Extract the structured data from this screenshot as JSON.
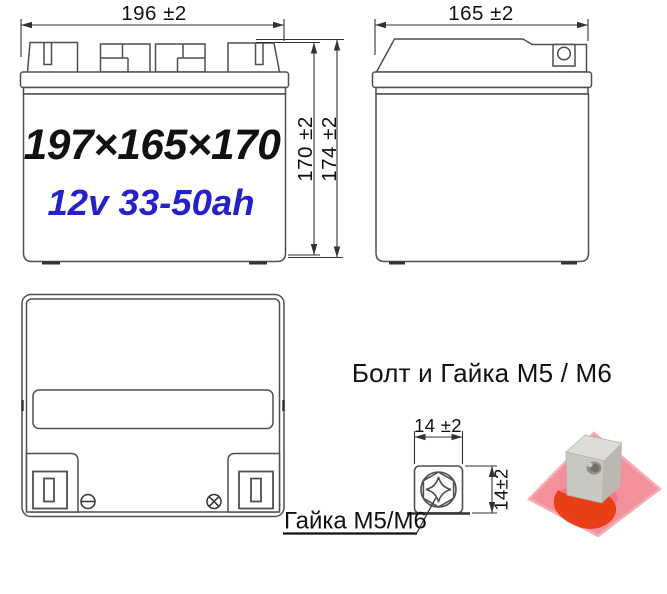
{
  "views": {
    "front": {
      "width_dim": "196 ±2",
      "case_height_dim": "170 ±2",
      "total_height_dim": "174 ±2",
      "size_label": "197×165×170",
      "rating_label": "12v 33-50ah"
    },
    "side": {
      "depth_dim": "165 ±2"
    },
    "top": {
      "negative_terminal_icon": "circled-minus",
      "positive_terminal_icon": "circled-cross"
    }
  },
  "hardware": {
    "title": "Болт и Гайка M5 / M6",
    "nut_width_dim": "14 ±2",
    "nut_height_dim": "14±2",
    "nut_callout": "Гайка M5/M6"
  },
  "colors": {
    "drawing_line": "#4f4f4f",
    "dimension_line": "#333333",
    "text": "#111111",
    "rating_blue": "#2421c8",
    "photo_plate_pink": "#f2919b",
    "photo_blob_red": "#e8380b",
    "photo_metal_gray": "#c9c8c2"
  }
}
